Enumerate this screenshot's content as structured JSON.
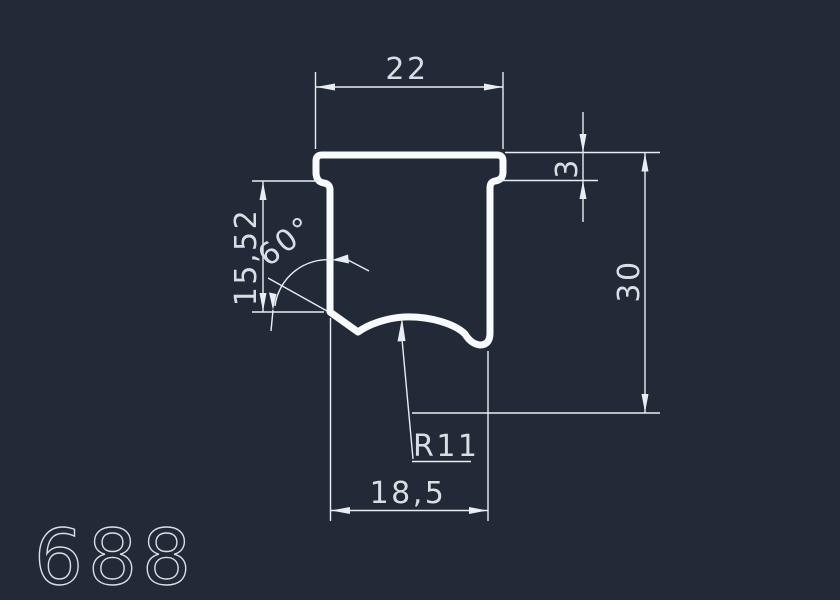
{
  "drawing": {
    "part_label": "688",
    "dimensions": {
      "top_width": "22",
      "lip_thickness": "3",
      "total_height": "30",
      "side_height": "15,52",
      "angle": "60°",
      "radius": "R11",
      "bottom_width": "18,5"
    },
    "colors": {
      "background": "#222937",
      "profile": "#f8fafc",
      "line": "#e9edf2",
      "text": "#d9dee5"
    }
  }
}
